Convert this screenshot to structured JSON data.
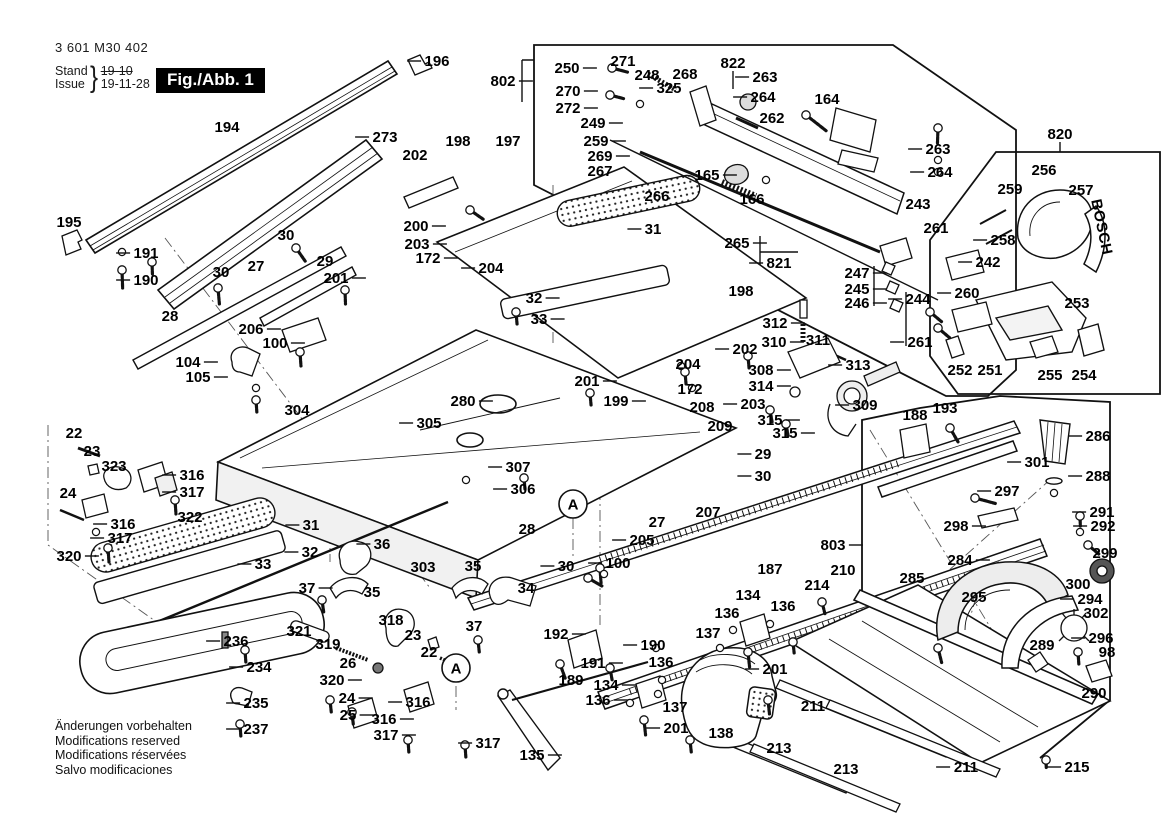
{
  "meta": {
    "part_number": "3 601 M30 402",
    "stand_label": "Stand",
    "issue_label": "Issue",
    "brace": "}",
    "stand_date_old": "19-10",
    "issue_date": "19-11-28",
    "fig_label": "Fig./Abb. 1"
  },
  "brand": {
    "text": "BOSCH"
  },
  "footer": {
    "lines": [
      "Änderungen vorbehalten",
      "Modifications reserved",
      "Modifications réservées",
      "Salvo modificaciones"
    ]
  },
  "markers": [
    {
      "t": "A",
      "x": 573,
      "y": 504
    },
    {
      "t": "A",
      "x": 456,
      "y": 668
    }
  ],
  "labels": [
    {
      "t": "196",
      "x": 437,
      "y": 61,
      "d": "l"
    },
    {
      "t": "802",
      "x": 503,
      "y": 81,
      "d": "r"
    },
    {
      "t": "250",
      "x": 567,
      "y": 68,
      "d": "r"
    },
    {
      "t": "271",
      "x": 623,
      "y": 61,
      "d": "n"
    },
    {
      "t": "248",
      "x": 647,
      "y": 75,
      "d": "n"
    },
    {
      "t": "268",
      "x": 685,
      "y": 74,
      "d": "n"
    },
    {
      "t": "822",
      "x": 733,
      "y": 63,
      "d": "n"
    },
    {
      "t": "263",
      "x": 765,
      "y": 77,
      "d": "l"
    },
    {
      "t": "264",
      "x": 763,
      "y": 97,
      "d": "l"
    },
    {
      "t": "270",
      "x": 568,
      "y": 91,
      "d": "r"
    },
    {
      "t": "272",
      "x": 568,
      "y": 108,
      "d": "r"
    },
    {
      "t": "325",
      "x": 669,
      "y": 88,
      "d": "l"
    },
    {
      "t": "249",
      "x": 593,
      "y": 123,
      "d": "r"
    },
    {
      "t": "259",
      "x": 596,
      "y": 141,
      "d": "r"
    },
    {
      "t": "269",
      "x": 600,
      "y": 156,
      "d": "r"
    },
    {
      "t": "267",
      "x": 600,
      "y": 171,
      "d": "n"
    },
    {
      "t": "266",
      "x": 657,
      "y": 196,
      "d": "n"
    },
    {
      "t": "165",
      "x": 707,
      "y": 175,
      "d": "r"
    },
    {
      "t": "166",
      "x": 752,
      "y": 199,
      "d": "n"
    },
    {
      "t": "164",
      "x": 827,
      "y": 99,
      "d": "n"
    },
    {
      "t": "820",
      "x": 1060,
      "y": 134,
      "d": "n"
    },
    {
      "t": "262",
      "x": 772,
      "y": 118,
      "d": "n"
    },
    {
      "t": "263",
      "x": 938,
      "y": 149,
      "d": "l"
    },
    {
      "t": "264",
      "x": 940,
      "y": 172,
      "d": "l"
    },
    {
      "t": "243",
      "x": 918,
      "y": 204,
      "d": "n"
    },
    {
      "t": "261",
      "x": 936,
      "y": 228,
      "d": "n"
    },
    {
      "t": "256",
      "x": 1044,
      "y": 170,
      "d": "n"
    },
    {
      "t": "259",
      "x": 1010,
      "y": 189,
      "d": "n"
    },
    {
      "t": "257",
      "x": 1081,
      "y": 190,
      "d": "n"
    },
    {
      "t": "258",
      "x": 1003,
      "y": 240,
      "d": "l"
    },
    {
      "t": "242",
      "x": 988,
      "y": 262,
      "d": "l"
    },
    {
      "t": "260",
      "x": 967,
      "y": 293,
      "d": "l"
    },
    {
      "t": "244",
      "x": 918,
      "y": 299,
      "d": "l"
    },
    {
      "t": "247",
      "x": 857,
      "y": 273,
      "d": "r"
    },
    {
      "t": "245",
      "x": 857,
      "y": 289,
      "d": "r"
    },
    {
      "t": "246",
      "x": 857,
      "y": 303,
      "d": "r"
    },
    {
      "t": "261",
      "x": 920,
      "y": 342,
      "d": "l"
    },
    {
      "t": "253",
      "x": 1077,
      "y": 303,
      "d": "n"
    },
    {
      "t": "252",
      "x": 960,
      "y": 370,
      "d": "n"
    },
    {
      "t": "251",
      "x": 990,
      "y": 370,
      "d": "n"
    },
    {
      "t": "255",
      "x": 1050,
      "y": 375,
      "d": "n"
    },
    {
      "t": "254",
      "x": 1084,
      "y": 375,
      "d": "n"
    },
    {
      "t": "194",
      "x": 227,
      "y": 127,
      "d": "n"
    },
    {
      "t": "273",
      "x": 385,
      "y": 137,
      "d": "l"
    },
    {
      "t": "195",
      "x": 69,
      "y": 222,
      "d": "n"
    },
    {
      "t": "191",
      "x": 146,
      "y": 253,
      "d": "l"
    },
    {
      "t": "190",
      "x": 146,
      "y": 280,
      "d": "l"
    },
    {
      "t": "198",
      "x": 458,
      "y": 141,
      "d": "n"
    },
    {
      "t": "197",
      "x": 508,
      "y": 141,
      "d": "n"
    },
    {
      "t": "202",
      "x": 415,
      "y": 155,
      "d": "n"
    },
    {
      "t": "200",
      "x": 416,
      "y": 226,
      "d": "r"
    },
    {
      "t": "203",
      "x": 417,
      "y": 244,
      "d": "r"
    },
    {
      "t": "172",
      "x": 428,
      "y": 258,
      "d": "r"
    },
    {
      "t": "204",
      "x": 491,
      "y": 268,
      "d": "l"
    },
    {
      "t": "30",
      "x": 286,
      "y": 235,
      "d": "n"
    },
    {
      "t": "29",
      "x": 325,
      "y": 261,
      "d": "n"
    },
    {
      "t": "27",
      "x": 256,
      "y": 266,
      "d": "n"
    },
    {
      "t": "201",
      "x": 336,
      "y": 278,
      "d": "r"
    },
    {
      "t": "30",
      "x": 221,
      "y": 272,
      "d": "n"
    },
    {
      "t": "28",
      "x": 170,
      "y": 316,
      "d": "n"
    },
    {
      "t": "206",
      "x": 251,
      "y": 329,
      "d": "r"
    },
    {
      "t": "100",
      "x": 275,
      "y": 343,
      "d": "r"
    },
    {
      "t": "104",
      "x": 188,
      "y": 362,
      "d": "r"
    },
    {
      "t": "105",
      "x": 198,
      "y": 377,
      "d": "r"
    },
    {
      "t": "304",
      "x": 297,
      "y": 410,
      "d": "n"
    },
    {
      "t": "31",
      "x": 653,
      "y": 229,
      "d": "l"
    },
    {
      "t": "265",
      "x": 737,
      "y": 243,
      "d": "r"
    },
    {
      "t": "821",
      "x": 779,
      "y": 263,
      "d": "l"
    },
    {
      "t": "32",
      "x": 534,
      "y": 298,
      "d": "r"
    },
    {
      "t": "33",
      "x": 539,
      "y": 319,
      "d": "r"
    },
    {
      "t": "198",
      "x": 741,
      "y": 291,
      "d": "n"
    },
    {
      "t": "202",
      "x": 745,
      "y": 349,
      "d": "l"
    },
    {
      "t": "201",
      "x": 587,
      "y": 381,
      "d": "r"
    },
    {
      "t": "199",
      "x": 616,
      "y": 401,
      "d": "r"
    },
    {
      "t": "204",
      "x": 688,
      "y": 364,
      "d": "n"
    },
    {
      "t": "172",
      "x": 690,
      "y": 389,
      "d": "n"
    },
    {
      "t": "203",
      "x": 753,
      "y": 404,
      "d": "l"
    },
    {
      "t": "208",
      "x": 702,
      "y": 407,
      "d": "n"
    },
    {
      "t": "209",
      "x": 720,
      "y": 426,
      "d": "n"
    },
    {
      "t": "280",
      "x": 463,
      "y": 401,
      "d": "r"
    },
    {
      "t": "305",
      "x": 429,
      "y": 423,
      "d": "l"
    },
    {
      "t": "307",
      "x": 518,
      "y": 467,
      "d": "l"
    },
    {
      "t": "306",
      "x": 523,
      "y": 489,
      "d": "l"
    },
    {
      "t": "28",
      "x": 527,
      "y": 529,
      "d": "n"
    },
    {
      "t": "27",
      "x": 657,
      "y": 522,
      "d": "n"
    },
    {
      "t": "205",
      "x": 642,
      "y": 540,
      "d": "l"
    },
    {
      "t": "207",
      "x": 708,
      "y": 512,
      "d": "n"
    },
    {
      "t": "29",
      "x": 763,
      "y": 454,
      "d": "l"
    },
    {
      "t": "30",
      "x": 763,
      "y": 476,
      "d": "l"
    },
    {
      "t": "312",
      "x": 775,
      "y": 323,
      "d": "r"
    },
    {
      "t": "310",
      "x": 774,
      "y": 342,
      "d": "r"
    },
    {
      "t": "311",
      "x": 818,
      "y": 340,
      "d": "n"
    },
    {
      "t": "313",
      "x": 858,
      "y": 365,
      "d": "l"
    },
    {
      "t": "308",
      "x": 761,
      "y": 370,
      "d": "r"
    },
    {
      "t": "314",
      "x": 761,
      "y": 386,
      "d": "r"
    },
    {
      "t": "315",
      "x": 770,
      "y": 420,
      "d": "r"
    },
    {
      "t": "315",
      "x": 785,
      "y": 433,
      "d": "r"
    },
    {
      "t": "309",
      "x": 865,
      "y": 405,
      "d": "l"
    },
    {
      "t": "188",
      "x": 915,
      "y": 415,
      "d": "n"
    },
    {
      "t": "193",
      "x": 945,
      "y": 408,
      "d": "n"
    },
    {
      "t": "286",
      "x": 1098,
      "y": 436,
      "d": "l"
    },
    {
      "t": "301",
      "x": 1037,
      "y": 462,
      "d": "l"
    },
    {
      "t": "288",
      "x": 1098,
      "y": 476,
      "d": "l"
    },
    {
      "t": "297",
      "x": 1007,
      "y": 491,
      "d": "l"
    },
    {
      "t": "298",
      "x": 956,
      "y": 526,
      "d": "r"
    },
    {
      "t": "291",
      "x": 1102,
      "y": 512,
      "d": "l"
    },
    {
      "t": "292",
      "x": 1103,
      "y": 526,
      "d": "l"
    },
    {
      "t": "284",
      "x": 960,
      "y": 560,
      "d": "r"
    },
    {
      "t": "299",
      "x": 1105,
      "y": 553,
      "d": "n"
    },
    {
      "t": "300",
      "x": 1078,
      "y": 584,
      "d": "n"
    },
    {
      "t": "294",
      "x": 1090,
      "y": 599,
      "d": "l"
    },
    {
      "t": "302",
      "x": 1096,
      "y": 613,
      "d": "n"
    },
    {
      "t": "295",
      "x": 974,
      "y": 597,
      "d": "n"
    },
    {
      "t": "289",
      "x": 1042,
      "y": 645,
      "d": "n"
    },
    {
      "t": "296",
      "x": 1101,
      "y": 638,
      "d": "l"
    },
    {
      "t": "98",
      "x": 1107,
      "y": 652,
      "d": "n"
    },
    {
      "t": "290",
      "x": 1094,
      "y": 693,
      "d": "n"
    },
    {
      "t": "210",
      "x": 843,
      "y": 570,
      "d": "n"
    },
    {
      "t": "214",
      "x": 817,
      "y": 585,
      "d": "n"
    },
    {
      "t": "285",
      "x": 912,
      "y": 578,
      "d": "n"
    },
    {
      "t": "803",
      "x": 833,
      "y": 545,
      "d": "r"
    },
    {
      "t": "187",
      "x": 770,
      "y": 569,
      "d": "n"
    },
    {
      "t": "322",
      "x": 190,
      "y": 517,
      "d": "n"
    },
    {
      "t": "316",
      "x": 192,
      "y": 475,
      "d": "l"
    },
    {
      "t": "317",
      "x": 192,
      "y": 492,
      "d": "l"
    },
    {
      "t": "316",
      "x": 123,
      "y": 524,
      "d": "l"
    },
    {
      "t": "317",
      "x": 120,
      "y": 538,
      "d": "l"
    },
    {
      "t": "320",
      "x": 69,
      "y": 556,
      "d": "r"
    },
    {
      "t": "22",
      "x": 74,
      "y": 433,
      "d": "n"
    },
    {
      "t": "23",
      "x": 92,
      "y": 451,
      "d": "n"
    },
    {
      "t": "323",
      "x": 114,
      "y": 466,
      "d": "n"
    },
    {
      "t": "24",
      "x": 68,
      "y": 493,
      "d": "n"
    },
    {
      "t": "31",
      "x": 311,
      "y": 525,
      "d": "l"
    },
    {
      "t": "32",
      "x": 310,
      "y": 552,
      "d": "l"
    },
    {
      "t": "33",
      "x": 263,
      "y": 564,
      "d": "l"
    },
    {
      "t": "36",
      "x": 382,
      "y": 544,
      "d": "l"
    },
    {
      "t": "35",
      "x": 372,
      "y": 592,
      "d": "n"
    },
    {
      "t": "37",
      "x": 307,
      "y": 588,
      "d": "r"
    },
    {
      "t": "303",
      "x": 423,
      "y": 567,
      "d": "n"
    },
    {
      "t": "321",
      "x": 299,
      "y": 631,
      "d": "n"
    },
    {
      "t": "319",
      "x": 328,
      "y": 644,
      "d": "n"
    },
    {
      "t": "26",
      "x": 348,
      "y": 663,
      "d": "n"
    },
    {
      "t": "320",
      "x": 332,
      "y": 680,
      "d": "r"
    },
    {
      "t": "24",
      "x": 347,
      "y": 698,
      "d": "r"
    },
    {
      "t": "25",
      "x": 348,
      "y": 715,
      "d": "r"
    },
    {
      "t": "318",
      "x": 391,
      "y": 620,
      "d": "n"
    },
    {
      "t": "23",
      "x": 413,
      "y": 635,
      "d": "n"
    },
    {
      "t": "22",
      "x": 429,
      "y": 652,
      "d": "n"
    },
    {
      "t": "236",
      "x": 236,
      "y": 641,
      "d": "l"
    },
    {
      "t": "234",
      "x": 259,
      "y": 667,
      "d": "l"
    },
    {
      "t": "235",
      "x": 256,
      "y": 703,
      "d": "l"
    },
    {
      "t": "237",
      "x": 256,
      "y": 729,
      "d": "l"
    },
    {
      "t": "316",
      "x": 418,
      "y": 702,
      "d": "l"
    },
    {
      "t": "316",
      "x": 384,
      "y": 719,
      "d": "r"
    },
    {
      "t": "317",
      "x": 386,
      "y": 735,
      "d": "r"
    },
    {
      "t": "317",
      "x": 488,
      "y": 743,
      "d": "l"
    },
    {
      "t": "35",
      "x": 473,
      "y": 566,
      "d": "n"
    },
    {
      "t": "30",
      "x": 566,
      "y": 566,
      "d": "l"
    },
    {
      "t": "34",
      "x": 526,
      "y": 588,
      "d": "n"
    },
    {
      "t": "100",
      "x": 618,
      "y": 563,
      "d": "l"
    },
    {
      "t": "37",
      "x": 474,
      "y": 626,
      "d": "n"
    },
    {
      "t": "192",
      "x": 556,
      "y": 634,
      "d": "r"
    },
    {
      "t": "190",
      "x": 653,
      "y": 645,
      "d": "l"
    },
    {
      "t": "191",
      "x": 593,
      "y": 663,
      "d": "r"
    },
    {
      "t": "189",
      "x": 571,
      "y": 680,
      "d": "n"
    },
    {
      "t": "134",
      "x": 606,
      "y": 685,
      "d": "r"
    },
    {
      "t": "136",
      "x": 661,
      "y": 662,
      "d": "n"
    },
    {
      "t": "136",
      "x": 598,
      "y": 700,
      "d": "r"
    },
    {
      "t": "137",
      "x": 675,
      "y": 707,
      "d": "n"
    },
    {
      "t": "201",
      "x": 676,
      "y": 728,
      "d": "l"
    },
    {
      "t": "138",
      "x": 721,
      "y": 733,
      "d": "n"
    },
    {
      "t": "135",
      "x": 532,
      "y": 755,
      "d": "r"
    },
    {
      "t": "134",
      "x": 748,
      "y": 595,
      "d": "n"
    },
    {
      "t": "136",
      "x": 783,
      "y": 606,
      "d": "n"
    },
    {
      "t": "136",
      "x": 727,
      "y": 613,
      "d": "n"
    },
    {
      "t": "137",
      "x": 708,
      "y": 633,
      "d": "n"
    },
    {
      "t": "201",
      "x": 775,
      "y": 669,
      "d": "l"
    },
    {
      "t": "213",
      "x": 779,
      "y": 748,
      "d": "n"
    },
    {
      "t": "211",
      "x": 813,
      "y": 706,
      "d": "n"
    },
    {
      "t": "213",
      "x": 846,
      "y": 769,
      "d": "n"
    },
    {
      "t": "211",
      "x": 966,
      "y": 767,
      "d": "l"
    },
    {
      "t": "215",
      "x": 1077,
      "y": 767,
      "d": "l"
    }
  ]
}
